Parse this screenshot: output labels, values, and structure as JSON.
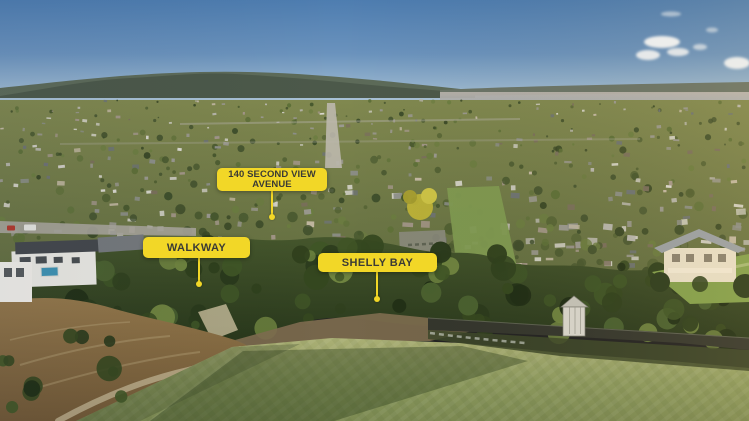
{
  "annotations": {
    "accent_color": "#F2D727",
    "text_color": "#3B3B35",
    "labels": [
      {
        "id": "address",
        "text": "140 SECOND VIEW\nAVENUE"
      },
      {
        "id": "walkway",
        "text": "WALKWAY"
      },
      {
        "id": "shelly_bay",
        "text": "SHELLY BAY"
      }
    ]
  },
  "scene": {
    "palette": {
      "sky_top": "#4E7DB0",
      "sky_horizon": "#C7D5DF",
      "cloud": "#FFFFFF",
      "distant_hills": "#4C594A",
      "harbour_water": "#AFAFAC",
      "suburb_light": "#80884F",
      "suburb_dark": "#5C683D",
      "house_roofs": [
        "#DCDAD2",
        "#CFCDC4",
        "#B9B7AE",
        "#9B9991",
        "#8D8F8A",
        "#A4978A",
        "#7B6F5D",
        "#6E7376",
        "#C4B9A4"
      ],
      "tree_greens": [
        "#3E4E2B",
        "#516032",
        "#5E7038",
        "#48582E",
        "#6B7D40",
        "#394826"
      ],
      "foreground_tree_greens": [
        "#1F2D15",
        "#2A3A1C",
        "#35471F",
        "#3F5526",
        "#4A6130",
        "#2F401D",
        "#6F8440"
      ],
      "grass_light": "#ABB075",
      "grass_dark": "#7C8A52",
      "mud": "#8F7347",
      "seawall": "#34362D",
      "pool": "#3F93B2",
      "yellow_tree": "#C9BD3C"
    }
  }
}
